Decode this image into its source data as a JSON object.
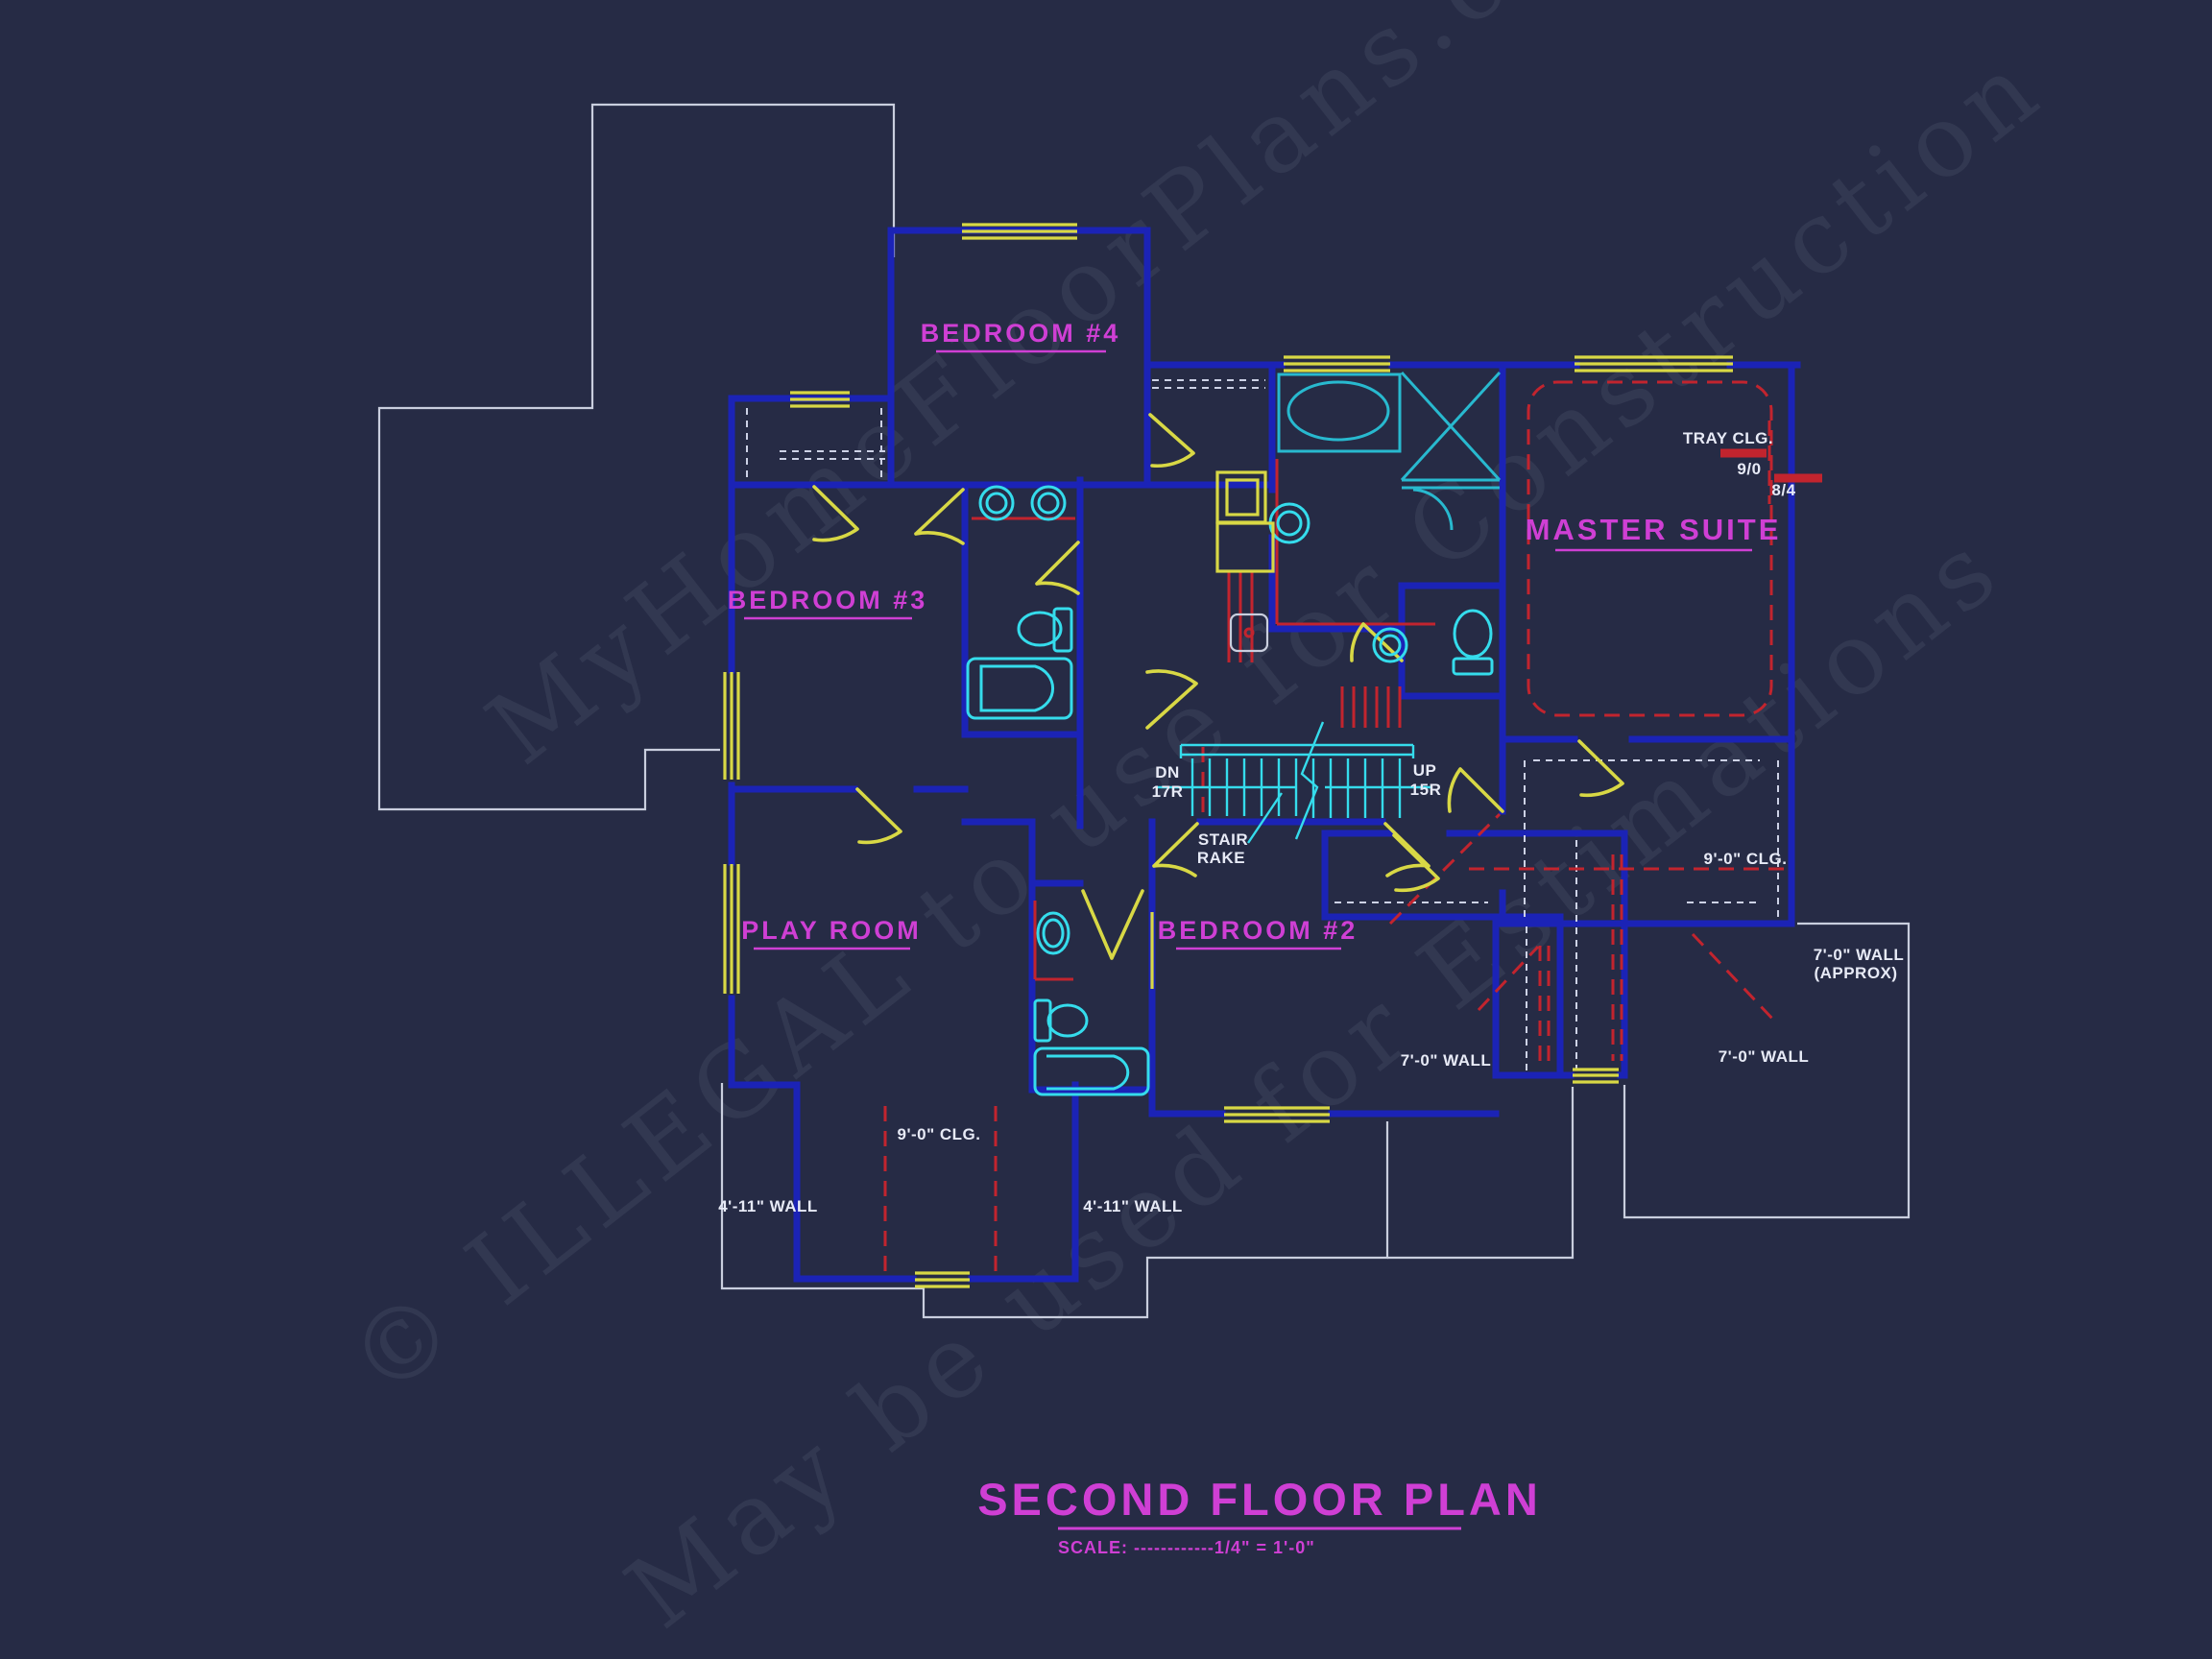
{
  "title_block": {
    "title": "SECOND FLOOR PLAN",
    "scale": "SCALE: ------------1/4\" = 1'-0\""
  },
  "room_labels": {
    "bedroom4": "BEDROOM #4",
    "bedroom3": "BEDROOM #3",
    "master_suite": "MASTER SUITE",
    "play_room": "PLAY ROOM",
    "bedroom2": "BEDROOM #2"
  },
  "annotations": {
    "tray_clg": "TRAY CLG.",
    "door_9_0": "9/0",
    "door_8_4": "8/4",
    "stair_dn": "DN",
    "stair_dn_risers": "17R",
    "stair_up": "UP",
    "stair_up_risers": "15R",
    "stair_rake_1": "STAIR",
    "stair_rake_2": "RAKE",
    "clg_9_right": "9'-0\" CLG.",
    "clg_9_bottom": "9'-0\" CLG.",
    "wall_7_approx_1": "7'-0\" WALL",
    "wall_7_approx_2": "(APPROX)",
    "wall_7_left": "7'-0\" WALL",
    "wall_7_right": "7'-0\" WALL",
    "wall_411_left": "4'-11\" WALL",
    "wall_411_right": "4'-11\" WALL"
  },
  "watermarks": {
    "line1": "MyHomeFloorPlans.com",
    "line2": "© ILLEGAL to use for Construction",
    "line3": "May be used for Estimations"
  },
  "colors": {
    "background": "#262b45",
    "wall_blue": "#1b23b6",
    "wall_highlight": "#3a46f2",
    "window_door_yellow": "#d8d845",
    "fixture_cyan": "#35dcec",
    "ceiling_red": "#c2242e",
    "label_magenta": "#cf3fd4",
    "annotation_white": "#e7eaf6",
    "roofline_white": "#c9cede"
  }
}
